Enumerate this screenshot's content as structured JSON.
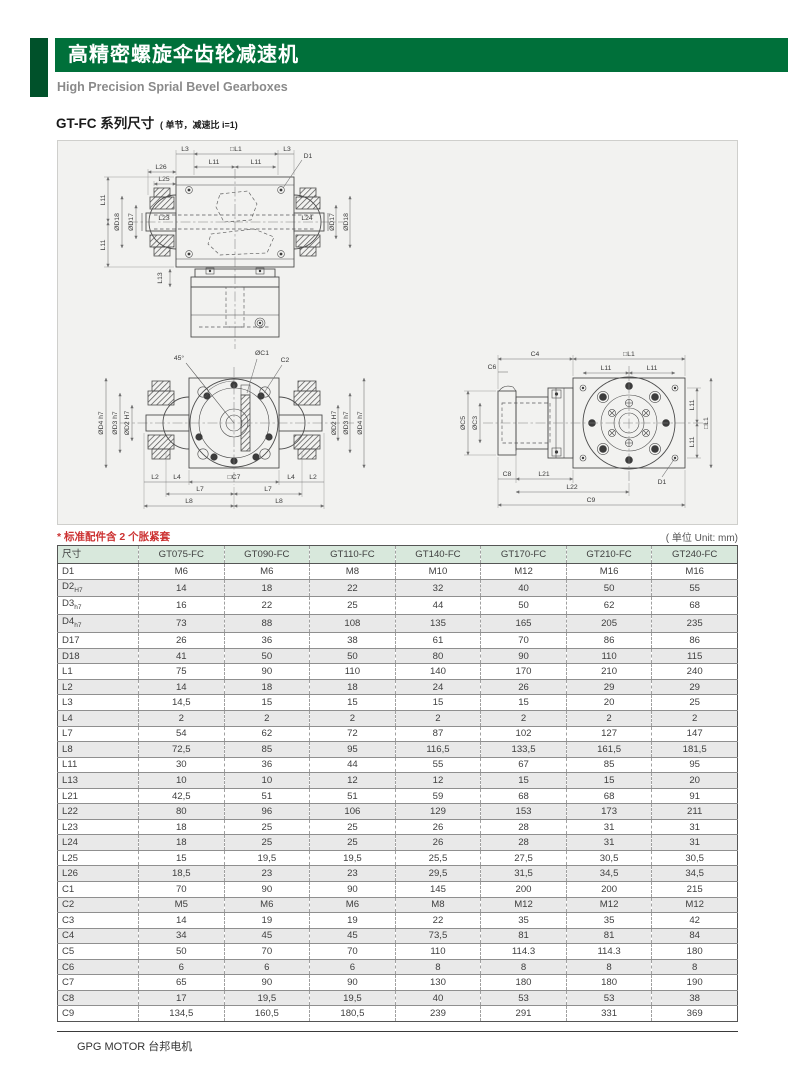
{
  "header": {
    "title_cn": "高精密螺旋伞齿轮减速机",
    "subtitle_en": "High Precision Sprial Bevel Gearboxes"
  },
  "section": {
    "title": "GT-FC 系列尺寸",
    "title_note": "( 单节，减速比 i=1)"
  },
  "note": {
    "text": "* 标准配件含 2 个胀紧套",
    "unit": "( 单位 Unit: mm)"
  },
  "colors": {
    "accent_green": "#00703a",
    "accent_green_dark": "#00512a",
    "note_red": "#cc3232",
    "table_header_bg": "#d8e8dc",
    "row_alt_bg": "#e9e9e9"
  },
  "drawing": {
    "front": {
      "labels": [
        "L3",
        "□L1",
        "L3",
        "L11",
        "L11",
        "D1",
        "L26",
        "L25",
        "L11",
        "L11",
        "ØD18",
        "ØD17",
        "L23",
        "L24",
        "ØD17",
        "ØD18",
        "L13"
      ]
    },
    "bottom": {
      "labels": [
        "45°",
        "ØC1",
        "C2",
        "ØD4 h7",
        "ØD3 h7",
        "ØD2 H7",
        "ØD2 H7",
        "ØD3 h7",
        "ØD4 h7",
        "L2",
        "L4",
        "□C7",
        "L4",
        "L2",
        "L7",
        "L7",
        "L8",
        "L8"
      ]
    },
    "side": {
      "labels": [
        "C6",
        "C4",
        "□L1",
        "L11",
        "L11",
        "ØC5",
        "ØC3",
        "L11",
        "□L1",
        "L11",
        "C8",
        "L21",
        "L22",
        "C9",
        "D1"
      ]
    }
  },
  "table": {
    "columns": [
      "尺寸",
      "GT075-FC",
      "GT090-FC",
      "GT110-FC",
      "GT140-FC",
      "GT170-FC",
      "GT210-FC",
      "GT240-FC"
    ],
    "rows": [
      {
        "label": "D1",
        "sub": "",
        "values": [
          "M6",
          "M6",
          "M8",
          "M10",
          "M12",
          "M16",
          "M16"
        ]
      },
      {
        "label": "D2",
        "sub": "H7",
        "values": [
          "14",
          "18",
          "22",
          "32",
          "40",
          "50",
          "55"
        ]
      },
      {
        "label": "D3",
        "sub": "h7",
        "values": [
          "16",
          "22",
          "25",
          "44",
          "50",
          "62",
          "68"
        ]
      },
      {
        "label": "D4",
        "sub": "h7",
        "values": [
          "73",
          "88",
          "108",
          "135",
          "165",
          "205",
          "235"
        ]
      },
      {
        "label": "D17",
        "sub": "",
        "values": [
          "26",
          "36",
          "38",
          "61",
          "70",
          "86",
          "86"
        ]
      },
      {
        "label": "D18",
        "sub": "",
        "values": [
          "41",
          "50",
          "50",
          "80",
          "90",
          "110",
          "115"
        ]
      },
      {
        "label": "L1",
        "sub": "",
        "values": [
          "75",
          "90",
          "110",
          "140",
          "170",
          "210",
          "240"
        ]
      },
      {
        "label": "L2",
        "sub": "",
        "values": [
          "14",
          "18",
          "18",
          "24",
          "26",
          "29",
          "29"
        ]
      },
      {
        "label": "L3",
        "sub": "",
        "values": [
          "14,5",
          "15",
          "15",
          "15",
          "15",
          "20",
          "25"
        ]
      },
      {
        "label": "L4",
        "sub": "",
        "values": [
          "2",
          "2",
          "2",
          "2",
          "2",
          "2",
          "2"
        ]
      },
      {
        "label": "L7",
        "sub": "",
        "values": [
          "54",
          "62",
          "72",
          "87",
          "102",
          "127",
          "147"
        ]
      },
      {
        "label": "L8",
        "sub": "",
        "values": [
          "72,5",
          "85",
          "95",
          "116,5",
          "133,5",
          "161,5",
          "181,5"
        ]
      },
      {
        "label": "L11",
        "sub": "",
        "values": [
          "30",
          "36",
          "44",
          "55",
          "67",
          "85",
          "95"
        ]
      },
      {
        "label": "L13",
        "sub": "",
        "values": [
          "10",
          "10",
          "12",
          "12",
          "15",
          "15",
          "20"
        ]
      },
      {
        "label": "L21",
        "sub": "",
        "values": [
          "42,5",
          "51",
          "51",
          "59",
          "68",
          "68",
          "91"
        ]
      },
      {
        "label": "L22",
        "sub": "",
        "values": [
          "80",
          "96",
          "106",
          "129",
          "153",
          "173",
          "211"
        ]
      },
      {
        "label": "L23",
        "sub": "",
        "values": [
          "18",
          "25",
          "25",
          "26",
          "28",
          "31",
          "31"
        ]
      },
      {
        "label": "L24",
        "sub": "",
        "values": [
          "18",
          "25",
          "25",
          "26",
          "28",
          "31",
          "31"
        ]
      },
      {
        "label": "L25",
        "sub": "",
        "values": [
          "15",
          "19,5",
          "19,5",
          "25,5",
          "27,5",
          "30,5",
          "30,5"
        ]
      },
      {
        "label": "L26",
        "sub": "",
        "values": [
          "18,5",
          "23",
          "23",
          "29,5",
          "31,5",
          "34,5",
          "34,5"
        ]
      },
      {
        "label": "C1",
        "sub": "",
        "values": [
          "70",
          "90",
          "90",
          "145",
          "200",
          "200",
          "215"
        ]
      },
      {
        "label": "C2",
        "sub": "",
        "values": [
          "M5",
          "M6",
          "M6",
          "M8",
          "M12",
          "M12",
          "M12"
        ]
      },
      {
        "label": "C3",
        "sub": "",
        "values": [
          "14",
          "19",
          "19",
          "22",
          "35",
          "35",
          "42"
        ]
      },
      {
        "label": "C4",
        "sub": "",
        "values": [
          "34",
          "45",
          "45",
          "73,5",
          "81",
          "81",
          "84"
        ]
      },
      {
        "label": "C5",
        "sub": "",
        "values": [
          "50",
          "70",
          "70",
          "110",
          "114.3",
          "114.3",
          "180"
        ]
      },
      {
        "label": "C6",
        "sub": "",
        "values": [
          "6",
          "6",
          "6",
          "8",
          "8",
          "8",
          "8"
        ]
      },
      {
        "label": "C7",
        "sub": "",
        "values": [
          "65",
          "90",
          "90",
          "130",
          "180",
          "180",
          "190"
        ]
      },
      {
        "label": "C8",
        "sub": "",
        "values": [
          "17",
          "19,5",
          "19,5",
          "40",
          "53",
          "53",
          "38"
        ]
      },
      {
        "label": "C9",
        "sub": "",
        "values": [
          "134,5",
          "160,5",
          "180,5",
          "239",
          "291",
          "331",
          "369"
        ]
      }
    ]
  },
  "footer": {
    "brand": "GPG MOTOR 台邦电机"
  }
}
